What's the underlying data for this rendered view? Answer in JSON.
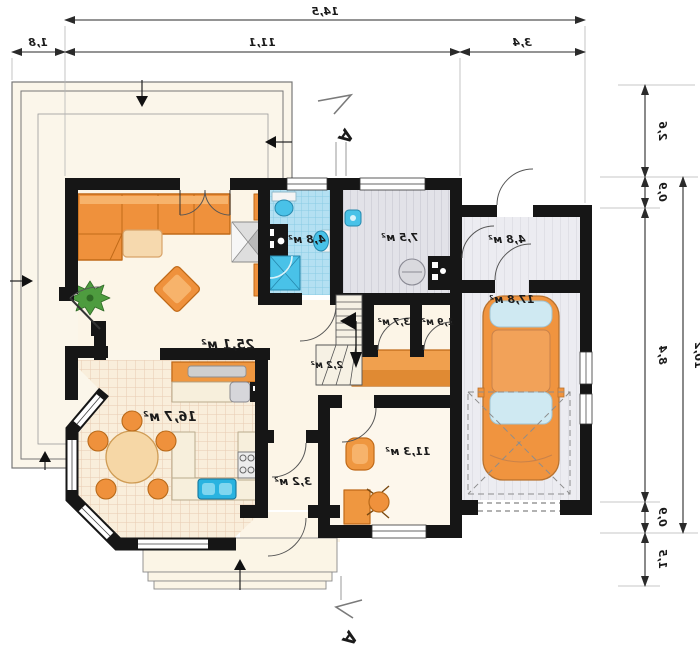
{
  "plan": {
    "rooms": {
      "living": "25,1 м²",
      "kitchen": "16,7 м²",
      "bathroom": "4,8 м²",
      "utility": "7,5 м²",
      "mudroom": "4,8 м²",
      "garage": "17,8 м²",
      "wc": "3,7 м²",
      "wardrobe": "1,9 м²",
      "stairs": "2,2 м²",
      "hall": "3,2 м²",
      "office": "11,3 м²"
    },
    "dimensions": {
      "top_overall": "14,5",
      "top_segments": [
        "1,8",
        "11,1",
        "3,4"
      ],
      "right_segments": [
        "2,6",
        "0,9",
        "8,4",
        "0,9",
        "1,5"
      ],
      "right_overall": "10,2"
    },
    "section_marker": "A",
    "colors": {
      "wall": "#161616",
      "floor_cream": "#fcf5e7",
      "terrace": "#fbf6ea",
      "furniture_orange": "#ef913c",
      "furniture_orange_dark": "#c06a18",
      "bath_tile_blue": "#b4e0f2",
      "fixture_blue": "#49c2e8",
      "kitchen_tile": "#f9eedb",
      "stripe_grey": "#e3e3e9",
      "dim_line": "#2a2a2a"
    }
  }
}
